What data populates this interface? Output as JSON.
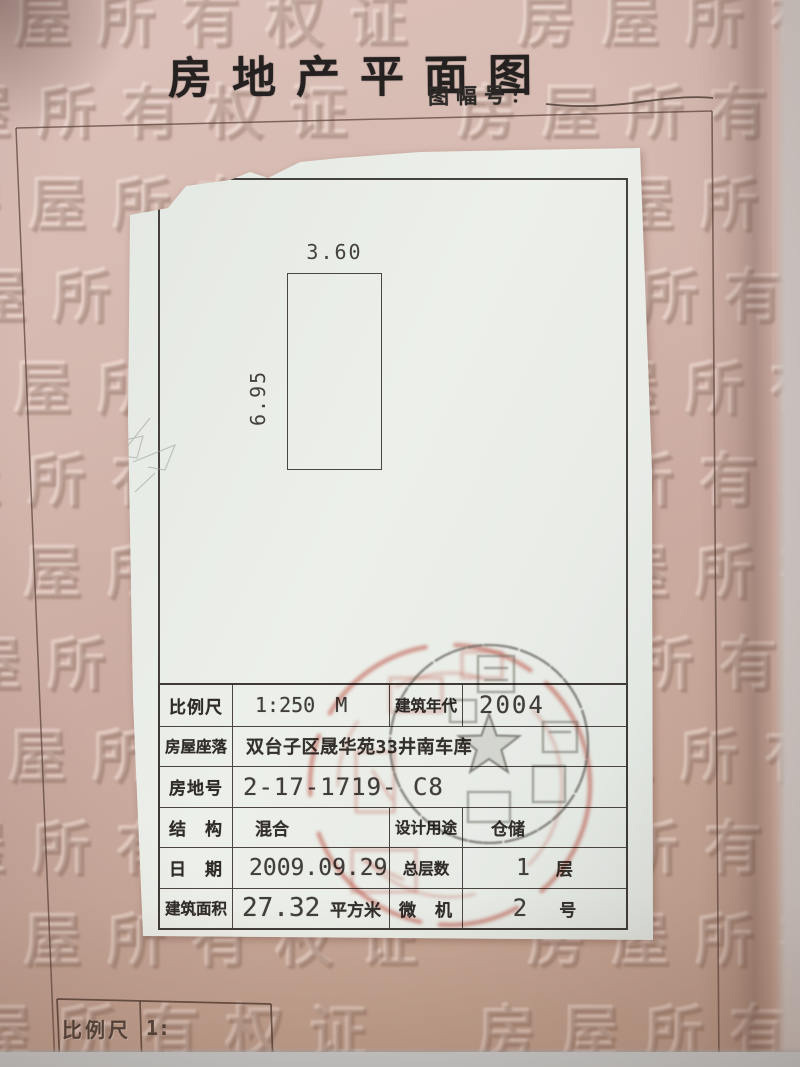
{
  "document": {
    "title": "房地产平面图",
    "sheet_no_label": "图幅号:",
    "watermark_row": "房屋所有权证　房屋所有权证　房屋所有权证",
    "bottom_scale_label": "比例尺",
    "bottom_scale_value": "1:"
  },
  "plan": {
    "width_m": "3.60",
    "depth_m": "6.95"
  },
  "info_table": {
    "rows": [
      {
        "label": "比例尺",
        "value_num": "1:250",
        "value_unit": "M",
        "label2": "建筑年代",
        "value2": "2004"
      },
      {
        "label": "房屋座落",
        "value": "双台子区晟华苑33井南车库"
      },
      {
        "label": "房地号",
        "value": "2-17-1719- C8"
      },
      {
        "label": "结　构",
        "value": "混合",
        "label2": "设计用途",
        "value2": "仓储"
      },
      {
        "label": "日　期",
        "value": "2009.09.29",
        "label2": "总层数",
        "value2_num": "1",
        "value2_unit": "层"
      },
      {
        "label": "建筑面积",
        "value_num": "27.32",
        "value_unit": "平方米",
        "label2": "微　机",
        "value2_num": "2",
        "value2_unit": "号"
      }
    ]
  },
  "colors": {
    "page_pink": "#cfa99e",
    "sheet_white": "#e9ece7",
    "ink": "#3b3733",
    "seal_red": "#c4483a",
    "seal_gray": "#85817c",
    "photo_edge": "#ccd3d5"
  }
}
